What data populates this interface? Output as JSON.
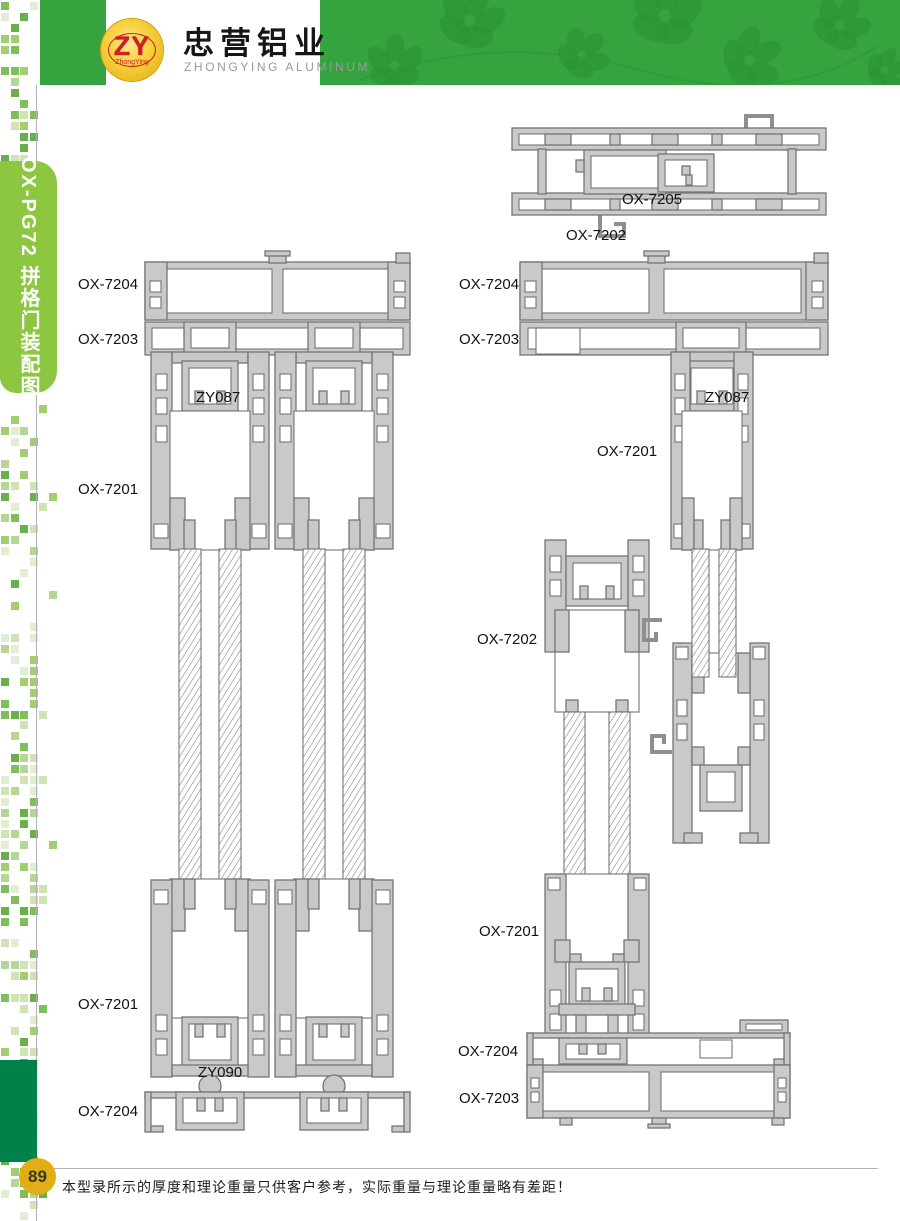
{
  "header": {
    "logo": {
      "monogram": "ZY",
      "logo_subtext": "ZhongYing"
    },
    "company_cn": "忠营铝业",
    "company_en": "ZHONGYING  ALUMINUM"
  },
  "sidebar": {
    "series_label": "OX-PG72 拼格门装配图"
  },
  "footer": {
    "page_number": "89",
    "note": "本型录所示的厚度和理论重量只供客户参考，实际重量与理论重量略有差距！"
  },
  "colors": {
    "header_green": "#35a33e",
    "tab_green": "#8dc63f",
    "deep_green": "#00814a",
    "badge_gold": "#e2ae15",
    "logo_red": "#cc2027",
    "profile_gray": "#c9c9c9",
    "line_gray": "#757575"
  },
  "diagram": {
    "labels": [
      {
        "text": "OX-7205",
        "x": 622,
        "y": 191
      },
      {
        "text": "OX-7202",
        "x": 566,
        "y": 227
      },
      {
        "text": "OX-7204",
        "x": 78,
        "y": 276
      },
      {
        "text": "OX-7203",
        "x": 78,
        "y": 331
      },
      {
        "text": "ZY087",
        "x": 196,
        "y": 389
      },
      {
        "text": "OX-7201",
        "x": 78,
        "y": 481
      },
      {
        "text": "OX-7201",
        "x": 78,
        "y": 996
      },
      {
        "text": "ZY090",
        "x": 198,
        "y": 1064
      },
      {
        "text": "OX-7204",
        "x": 78,
        "y": 1103
      },
      {
        "text": "OX-7204",
        "x": 459,
        "y": 276
      },
      {
        "text": "OX-7203",
        "x": 459,
        "y": 331
      },
      {
        "text": "ZY087",
        "x": 705,
        "y": 389
      },
      {
        "text": "OX-7201",
        "x": 597,
        "y": 443
      },
      {
        "text": "OX-7202",
        "x": 477,
        "y": 631
      },
      {
        "text": "OX-7201",
        "x": 479,
        "y": 923
      },
      {
        "text": "OX-7204",
        "x": 458,
        "y": 1043
      },
      {
        "text": "OX-7203",
        "x": 459,
        "y": 1090
      }
    ]
  }
}
